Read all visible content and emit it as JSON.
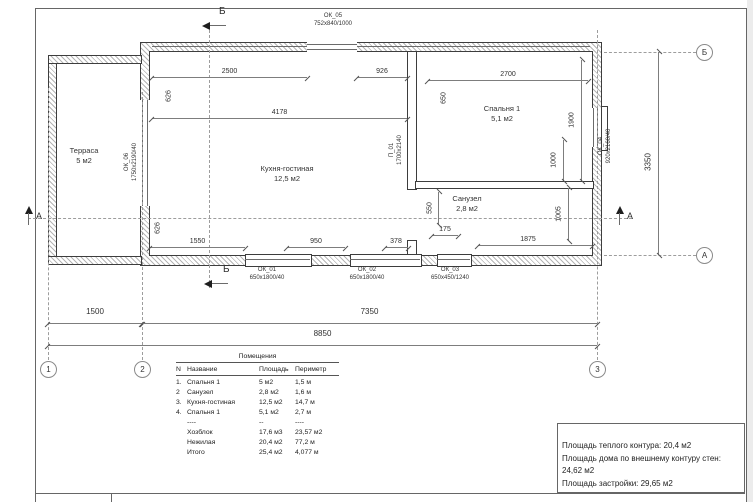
{
  "markers": {
    "section_b_top": "Б",
    "section_b_bottom": "Б",
    "section_a_left": "А",
    "section_a_right": "А",
    "axis_b_circle": "Б",
    "axis_a_circle": "А",
    "grid_1": "1",
    "grid_2": "2",
    "grid_3": "3"
  },
  "rooms": {
    "terrace": {
      "name": "Терраса",
      "area": "5 м2"
    },
    "kitchen_living": {
      "name": "Кухня-гостиная",
      "area": "12,5 м2"
    },
    "bedroom": {
      "name": "Спальня 1",
      "area": "5,1 м2"
    },
    "bathroom": {
      "name": "Санузел",
      "area": "2,8 м2"
    }
  },
  "openings": {
    "ok01": {
      "name": "ОК_01",
      "size": "650х1800/40"
    },
    "ok02": {
      "name": "ОК_02",
      "size": "650х1800/40"
    },
    "ok03": {
      "name": "ОК_03",
      "size": "650х450/1240"
    },
    "ok04": {
      "name": "ОК_04",
      "size": "920х2160/40"
    },
    "ok05": {
      "name": "ОК_05",
      "size": "752х840/1000"
    },
    "ok06": {
      "name": "ОК_06",
      "size": "1750х2190/40"
    },
    "p01": {
      "name": "П_01",
      "size": "1700х2140"
    }
  },
  "dimensions": {
    "top_left": "2500",
    "top_mid": "926",
    "top_right": "2700",
    "kitchen_width": "4178",
    "v_626_top": "626",
    "v_650_bedroom": "650",
    "v_1900": "1900",
    "v_1000": "1000",
    "v_1005": "1005",
    "v_550": "550",
    "v_626_bottom": "626",
    "v_3350": "3350",
    "b_1550": "1550",
    "b_950": "950",
    "b_378": "378",
    "b_175": "175",
    "b_1875": "1875",
    "chain_1500": "1500",
    "chain_7350": "7350",
    "chain_total": "8850"
  },
  "table": {
    "title": "Помещения",
    "headers": [
      "N",
      "Название",
      "Площадь",
      "Периметр"
    ],
    "rows": [
      [
        "1.",
        "Спальня 1",
        "5 м2",
        "1,5 м"
      ],
      [
        "2",
        "Санузел",
        "2,8 м2",
        "1,6 м"
      ],
      [
        "3.",
        "Кухня-гостиная",
        "12,5 м2",
        "14,7 м"
      ],
      [
        "4.",
        "Спальня 1",
        "5,1 м2",
        "2,7 м"
      ],
      [
        "",
        "----",
        "--",
        "----"
      ],
      [
        "",
        "Хозблок",
        "17,6 м3",
        "23,57 м2"
      ],
      [
        "",
        "Нежилая",
        "20,4 м2",
        "77,2 м"
      ],
      [
        "",
        "Итого",
        "25,4 м2",
        "4,077 м"
      ]
    ]
  },
  "summary": {
    "line1": "Площадь теплого контура: 20,4 м2",
    "line2": "Площадь дома по внешнему контуру стен: 24,62 м2",
    "line3": "Площадь застройки: 29,65 м2"
  },
  "colors": {
    "line": "#4a4a4a",
    "text": "#2f2f2f"
  }
}
